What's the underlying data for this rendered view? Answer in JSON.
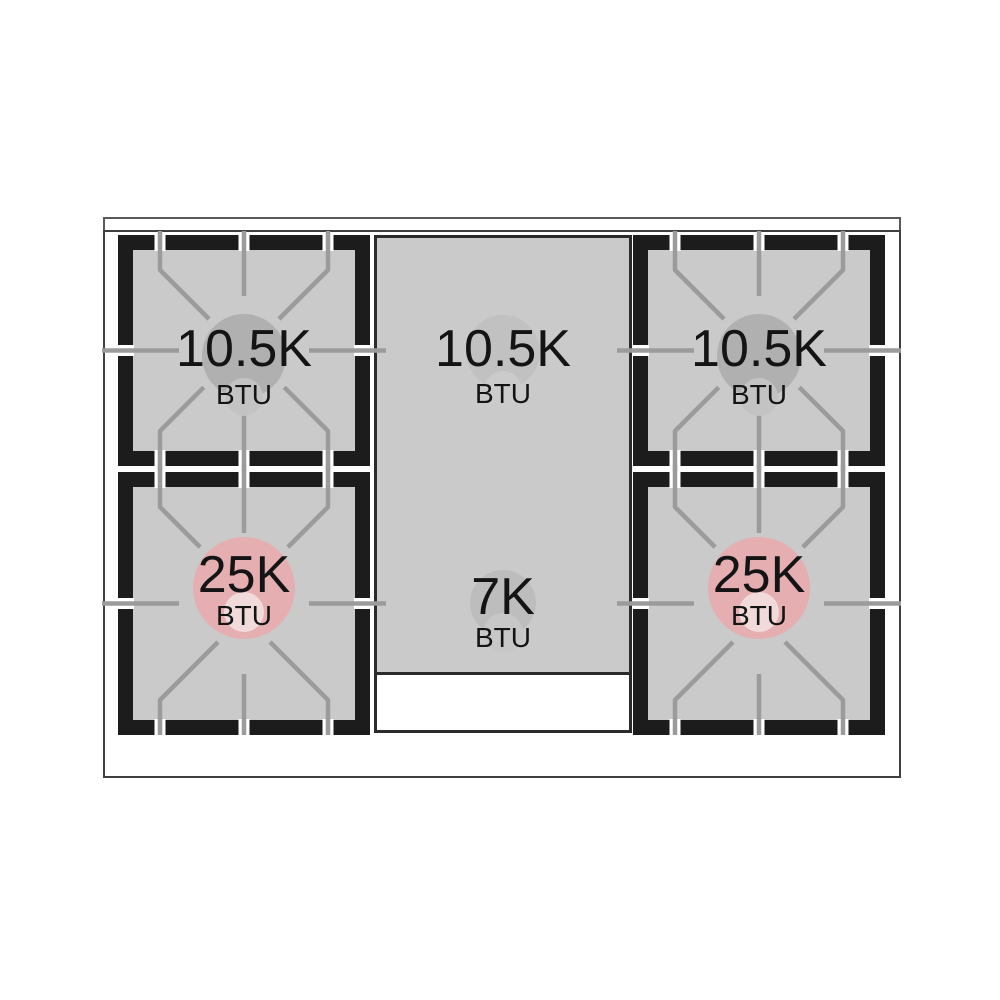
{
  "diagram": {
    "kind": "gas-cooktop-top-view",
    "burner_count": "5"
  },
  "burners": [
    {
      "position": "rear-left",
      "value": "10.5K",
      "unit": "BTU"
    },
    {
      "position": "rear-center",
      "value": "10.5K",
      "unit": "BTU"
    },
    {
      "position": "rear-right",
      "value": "10.5K",
      "unit": "BTU"
    },
    {
      "position": "front-left",
      "value": "25K",
      "unit": "BTU"
    },
    {
      "position": "front-center",
      "value": "7K",
      "unit": "BTU"
    },
    {
      "position": "front-right",
      "value": "25K",
      "unit": "BTU"
    }
  ],
  "colors": {
    "background": "#ffffff",
    "outline": "#3f3f3f",
    "frame": "#1c1c1c",
    "surface": "#cacaca",
    "grate": "#9b9b9b",
    "slot": "#ffffff",
    "text": "#141414",
    "burner_gray": "#b0b0b0",
    "burner_gray_sub": "#c3c3c3",
    "pink": "#e5aeb0",
    "pink_hole": "#f1dada",
    "center_circle": "#c1c1c1",
    "center_circle_sub": "#cbcbcb",
    "small_circle": "#bdbdbd",
    "small_circle_sub": "#c7c7c7"
  }
}
